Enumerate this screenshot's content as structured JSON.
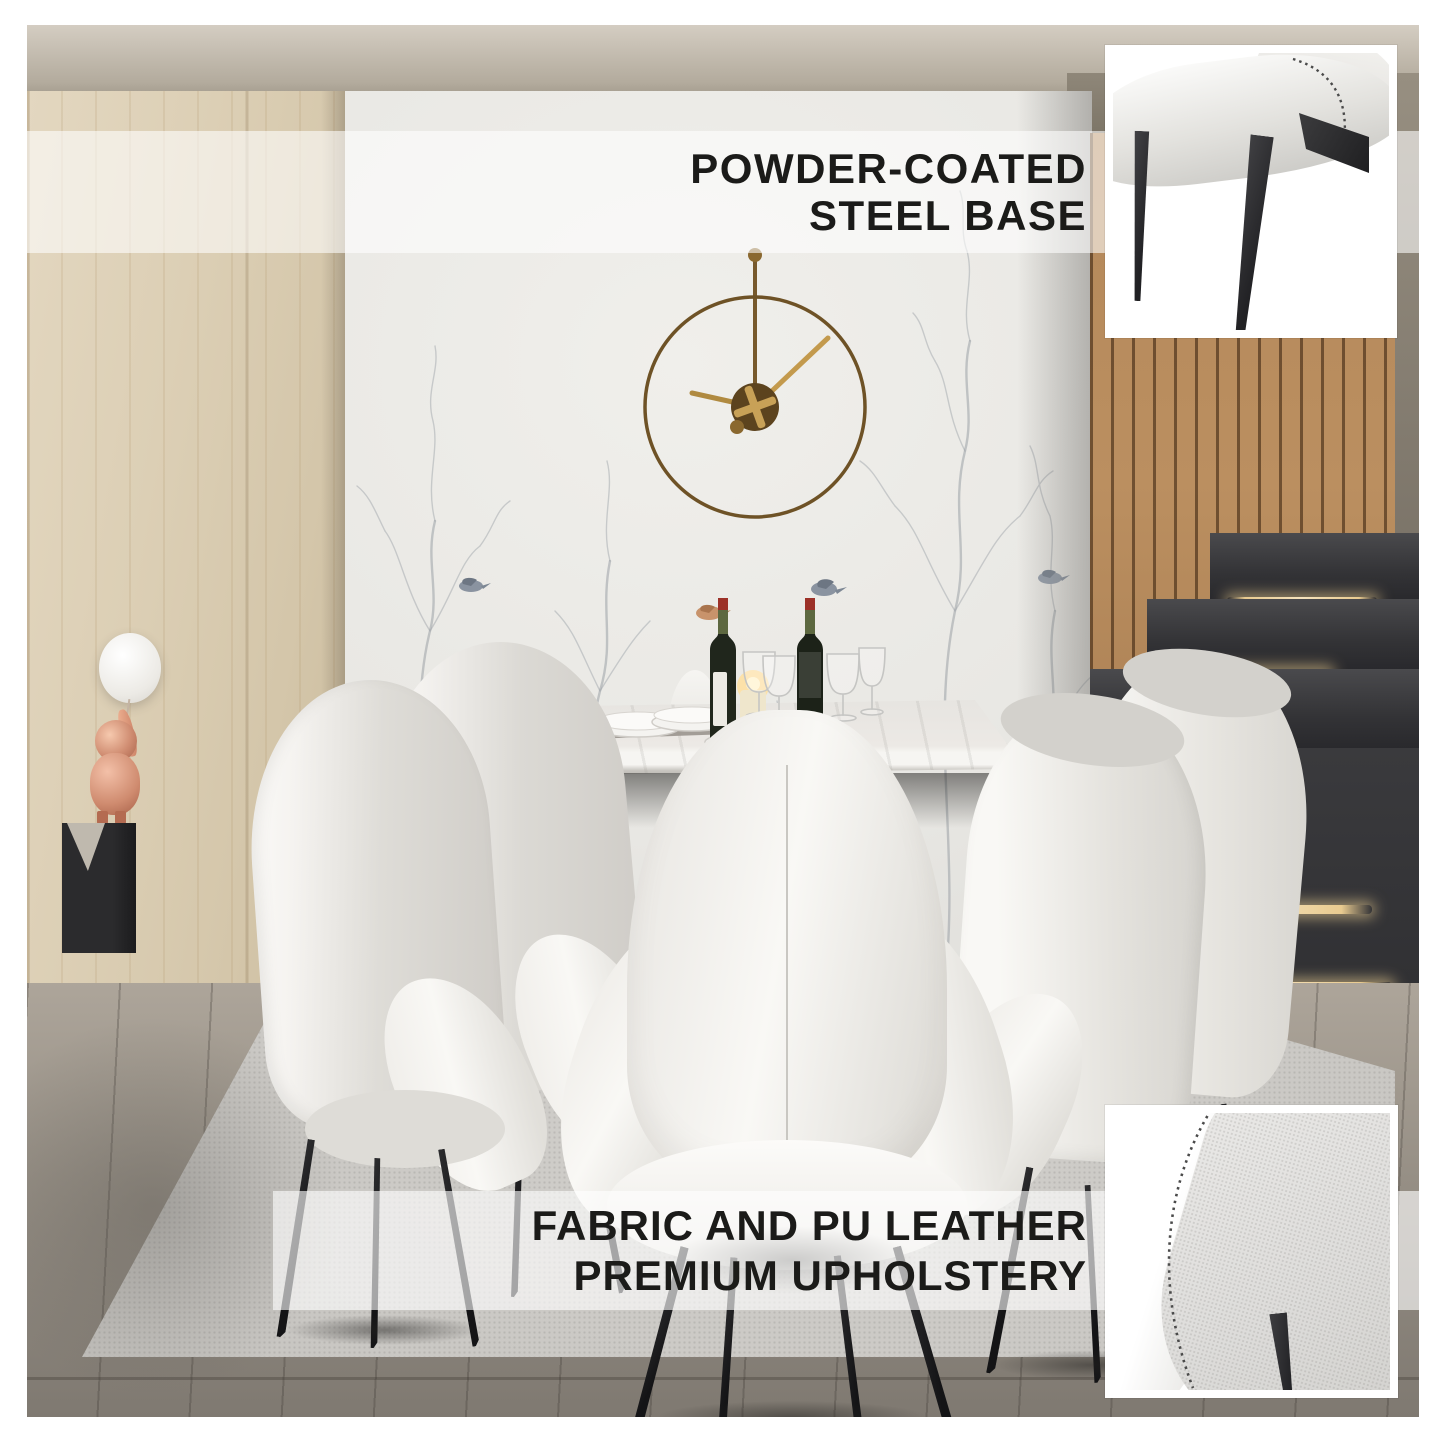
{
  "callouts": {
    "steel_base": {
      "line1": "POWDER-COATED",
      "line2": "STEEL BASE"
    },
    "upholstery": {
      "line1": "FABRIC AND PU LEATHER",
      "line2": "PREMIUM UPHOLSTERY"
    }
  },
  "colors": {
    "callout_text": "#1b1b19",
    "callout_band": "rgba(255,255,255,0.6)",
    "chair_upholstery": "#f2f0ec",
    "chair_fabric": "#d8d6d1",
    "chair_leg_steel": "#1c1c1e",
    "clock_brass": "#6e5226",
    "stair_led": "#f0d9a8",
    "figurine_copper": "#d99a82",
    "wood_wall": "#dccfb5",
    "slat_wall": "#b4885a",
    "rug": "#c8c6c2"
  }
}
